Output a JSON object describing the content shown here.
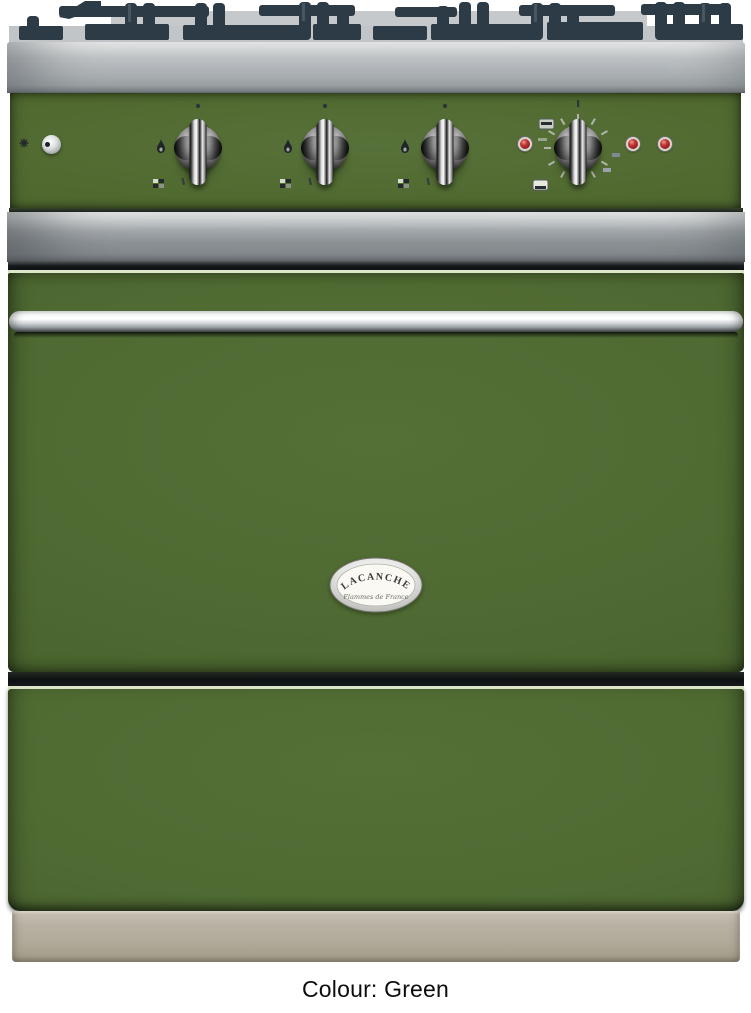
{
  "caption": {
    "text": "Colour: Green"
  },
  "badge": {
    "title": "LACANCHE",
    "subtitle": "Flammes de France"
  },
  "product": {
    "appliance": "range cooker product photo",
    "colour_option": "Green",
    "colors": {
      "body_green": "#4e6831",
      "stainless_trim": "#b4b9bc",
      "plinth_beige": "#b1aa9c",
      "grate_iron": "#2d3b46",
      "indicator_red": "#a2292c",
      "knob_chrome": "#d9d9d9",
      "caption_text": "#0c0c0c"
    },
    "controls": {
      "burner_knobs": 3,
      "oven_thermostat_knob": 1,
      "ignition_button": 1,
      "indicator_lights": 3
    },
    "icons": [
      "ignition-spark-icon",
      "flame-icon",
      "simmer-grid-icon",
      "knob-position-dot",
      "grill-icon",
      "oven-mode-icon",
      "thermostat-tick-marks"
    ]
  }
}
